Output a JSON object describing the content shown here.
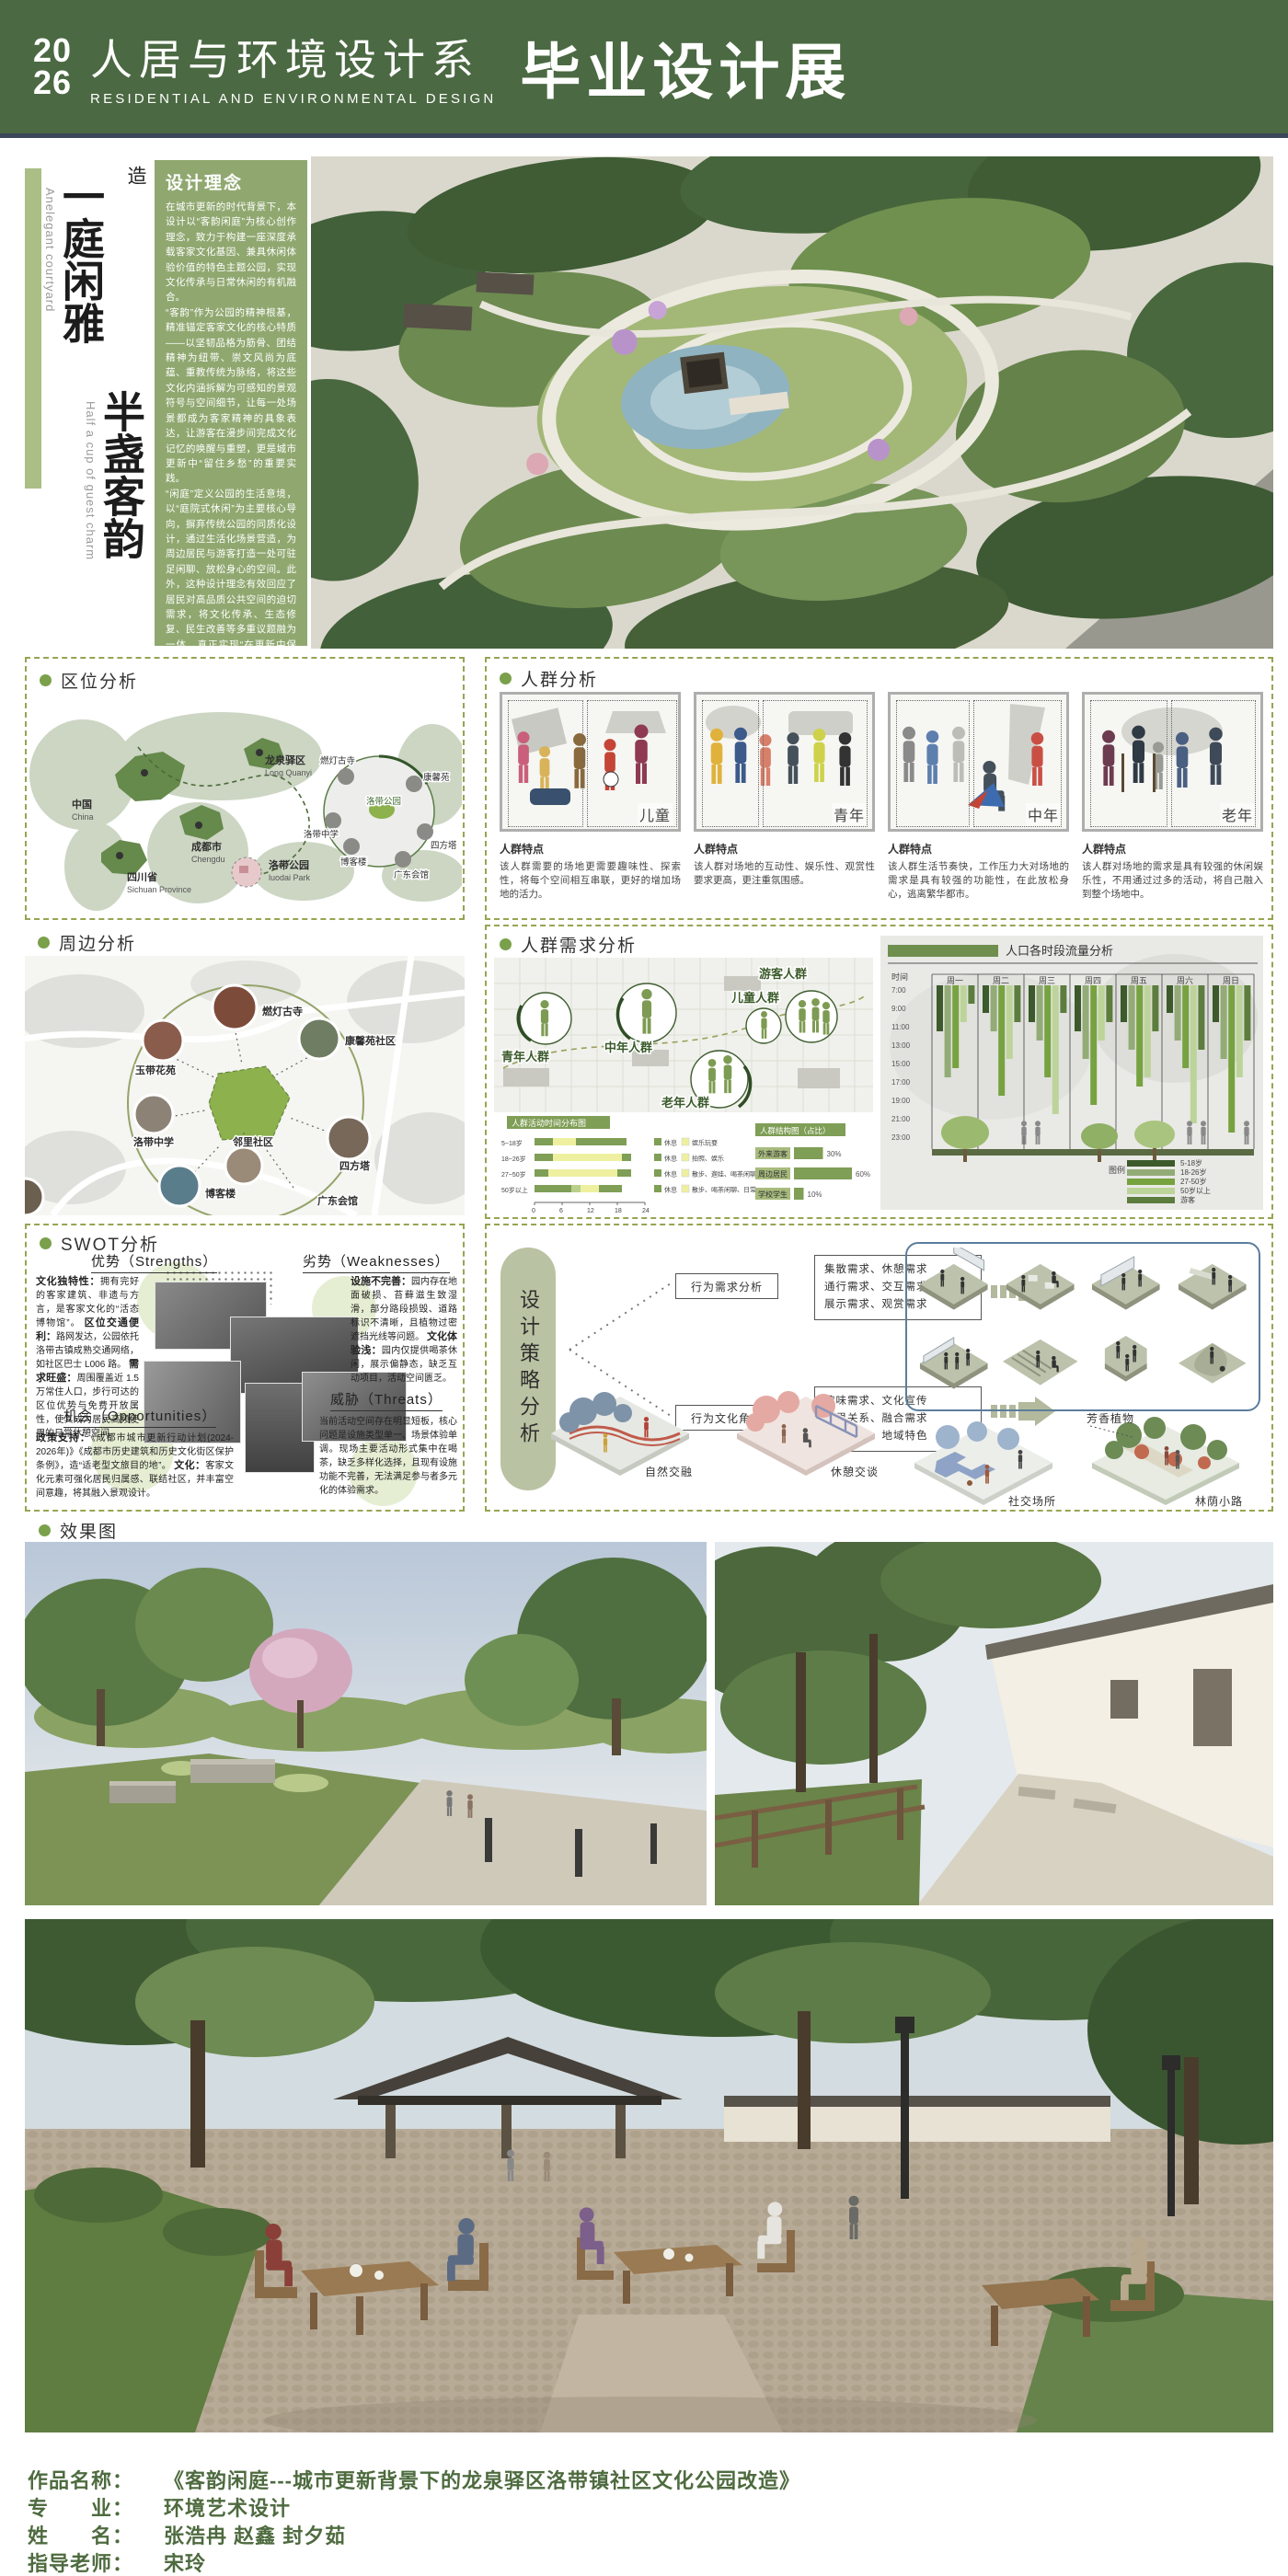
{
  "header": {
    "year_line1": "20",
    "year_line2": "26",
    "dept_cn": "人居与环境设计系",
    "dept_en": "RESIDENTIAL AND ENVIRONMENTAL DESIGN",
    "exhibition": "毕业设计展"
  },
  "hero": {
    "title_col1": "一庭闲雅",
    "title_col2": "半盏客韵",
    "title_en1": "Anelegant courtyard",
    "title_en2": "Half a cup of guest charm",
    "subtitle": "城市更新背景下的龙泉驿区洛带镇社区文化公园改造",
    "concept": {
      "title": "设计理念",
      "p1": "在城市更新的时代背景下，本设计以“客韵闲庭”为核心创作理念，致力于构建一座深度承载客家文化基因、兼具休闲体验价值的特色主题公园，实现文化传承与日常休闲的有机融合。",
      "p2": "“客韵”作为公园的精神根基，精准锚定客家文化的核心特质——以坚韧品格为筋骨、团结精神为纽带、崇文风尚为底蕴、重教传统为脉络，将这些文化内涵拆解为可感知的景观符号与空间细节，让每一处场景都成为客家精神的具象表达，让游客在漫步间完成文化记忆的唤醒与重塑，更是城市更新中“留住乡愁”的重要实践。",
      "p3": "“闲庭”定义公园的生活意境，以“庭院式休闲”为主要核心导向，摒弃传统公园的同质化设计，通过生活化场景营造，为周边居民与游客打造一处可驻足闲聊、放松身心的空间。此外，这种设计理念有效回应了居民对高品质公共空间的迫切需求，将文化传承、生态修复、民生改善等多重议题融为一体，真正实现“在更新中保护，在保护中发展”的可持续更新理念。"
    }
  },
  "location": {
    "label": "区位分析",
    "markers": [
      {
        "cn": "中国",
        "en": "China"
      },
      {
        "cn": "四川省",
        "en": "Sichuan Province"
      },
      {
        "cn": "成都市",
        "en": "Chengdu"
      },
      {
        "cn": "龙泉驿区",
        "en": "Long Quanyi"
      },
      {
        "cn": "洛带公园",
        "en": "luodai Park"
      }
    ],
    "inset": [
      "燃灯古寺",
      "康馨苑",
      "洛带公园",
      "洛带中学",
      "博客楼",
      "四方塔",
      "广东会馆"
    ]
  },
  "crowd": {
    "label": "人群分析",
    "trait_title": "人群特点",
    "groups": [
      {
        "name": "儿童",
        "trait": "该人群需要的场地更需要趣味性、探索性，将每个空间相互串联，更好的增加场地的活力。"
      },
      {
        "name": "青年",
        "trait": "该人群对场地的互动性、娱乐性、观赏性要求更高，更注重氛围感。"
      },
      {
        "name": "中年",
        "trait": "该人群生活节奏快，工作压力大对场地的需求是具有较强的功能性，在此放松身心，逃离繁华都市。"
      },
      {
        "name": "老年",
        "trait": "该人群对场地的需求是具有较强的休闲娱乐性，不用通过过多的活动，将自己融入到整个场地中。"
      }
    ]
  },
  "surrounding": {
    "label": "周边分析",
    "poi": [
      "燃灯古寺",
      "玉带花苑",
      "康馨苑社区",
      "洛带中学",
      "邻里社区",
      "四方塔",
      "博客楼",
      "广东会馆"
    ]
  },
  "needs": {
    "label": "人群需求分析",
    "map_groups": [
      "青年人群",
      "中年人群",
      "儿童人群",
      "游客人群",
      "老年人群"
    ]
  },
  "swot": {
    "label": "SWOT分析",
    "s_title": "优势（Strengths）",
    "w_title": "劣势（Weaknesses）",
    "o_title": "机会（Opportunities）",
    "t_title": "威胁（Threats）",
    "strengths": [
      {
        "lead": "文化独特性：",
        "text": "拥有完好的客家建筑、非遗与方言，是客家文化的“活态博物馆”。"
      },
      {
        "lead": "区位交通便利：",
        "text": "路网发达，公园依托洛带古镇成熟交通网络，如社区巴士 L006 路。"
      },
      {
        "lead": "需求旺盛：",
        "text": "周围覆盖近 1.5 万常住人口，步行可达的区位优势与免费开放属性，使其成为居民高频使用的日常休憩空间。"
      }
    ],
    "weaknesses": [
      {
        "lead": "设施不完善：",
        "text": "园内存在地面破损、苔藓滋生致湿滑，部分路段损毁、道路标识不清晰，且植物过密遮挡光线等问题。"
      },
      {
        "lead": "文化体验浅：",
        "text": "园内仅提供喝茶休闲，展示偏静态，缺乏互动项目，活动空间匮乏。"
      }
    ],
    "opportunities": [
      {
        "lead": "政策支持：",
        "text": "《成都市城市更新行动计划(2024-2026年)》《成都市历史建筑和历史文化街区保护条例》，造“适老型文旅目的地”。"
      },
      {
        "lead": "文化：",
        "text": "客家文化元素可强化居民归属感、联结社区，并丰富空间意趣，将其融入景观设计。"
      }
    ],
    "threats": [
      {
        "lead": "",
        "text": "当前活动空间存在明显短板，核心问题是设施类型单一、场景体验单调。现场主要活动形式集中在喝茶，缺乏多样化选择，且现有设施功能不完善，无法满足参与者多元化的体验需求。"
      }
    ]
  },
  "strategy": {
    "label": "设计策略分析",
    "pill": "设计策略分析",
    "b1": "行为需求分析",
    "b1_items": [
      "集散需求、休憩需求",
      "通行需求、交互需求",
      "展示需求、观赏需求"
    ],
    "b2": "行为文化角度",
    "b2_items": [
      "趣味需求、文化宣传",
      "邻里关系、融合需求",
      "知识普及、地域特色"
    ],
    "scenes": [
      "自然交融",
      "休憩交谈",
      "社交场所",
      "林荫小路"
    ],
    "annotation": "芳香植物"
  },
  "renders": {
    "label": "效果图"
  },
  "footer": {
    "rows": [
      {
        "k": "作品名称：",
        "v": "《客韵闲庭---城市更新背景下的龙泉驿区洛带镇社区文化公园改造》"
      },
      {
        "k": "专　　业：",
        "v": "环境艺术设计"
      },
      {
        "k": "姓　　名：",
        "v": "张浩冉  赵鑫  封夕茹"
      },
      {
        "k": "指导老师：",
        "v": "宋玲"
      }
    ]
  },
  "chart_data": [
    {
      "id": "activity",
      "type": "bar",
      "title": "人群活动时间分布图",
      "orientation": "horizontal-stacked",
      "xlabel": "时刻（时）",
      "x_ticks": [
        0,
        6,
        12,
        18,
        24
      ],
      "xlim": [
        0,
        24
      ],
      "legend_green": "休息",
      "rows": [
        {
          "label": "5~18岁",
          "segments": [
            [
              0,
              4,
              "g"
            ],
            [
              4,
              9,
              "y"
            ],
            [
              9,
              20,
              "g"
            ]
          ],
          "legend_yellow": "娱乐玩耍"
        },
        {
          "label": "18~26岁",
          "segments": [
            [
              0,
              4,
              "g"
            ],
            [
              4,
              19,
              "y"
            ],
            [
              19,
              21,
              "g"
            ]
          ],
          "legend_yellow": "拍照、娱乐"
        },
        {
          "label": "27~50岁",
          "segments": [
            [
              0,
              3,
              "g"
            ],
            [
              3,
              18,
              "y"
            ],
            [
              18,
              21,
              "g"
            ]
          ],
          "legend_yellow": "散步、遛娃、喝茶闲聊"
        },
        {
          "label": "50岁以上",
          "segments": [
            [
              0,
              8,
              "g"
            ],
            [
              8,
              10,
              "lg"
            ],
            [
              10,
              14,
              "y"
            ],
            [
              14,
              19,
              "g"
            ]
          ],
          "legend_yellow": "散步、喝茶闲聊、日常"
        }
      ]
    },
    {
      "id": "structure",
      "type": "bar",
      "title": "人群结构图（占比）",
      "unit": "%",
      "items": [
        {
          "label": "外来游客",
          "value": 30
        },
        {
          "label": "周边居民",
          "value": 60
        },
        {
          "label": "学校学生",
          "value": 10
        }
      ]
    },
    {
      "id": "flow",
      "type": "bar",
      "title": "人口各时段流量分析",
      "ylabel": "时间",
      "y_ticks": [
        "7:00",
        "9:00",
        "11:00",
        "13:00",
        "15:00",
        "17:00",
        "19:00",
        "21:00",
        "23:00"
      ],
      "days": [
        "周一",
        "周二",
        "周三",
        "周四",
        "周五",
        "周六",
        "周日"
      ],
      "legend_title": "图例",
      "legend": [
        "5-18岁",
        "18-26岁",
        "27-50岁",
        "50岁以上",
        "游客"
      ],
      "legend_colors": [
        "#3d5a2c",
        "#93ab77",
        "#76a23f",
        "#bcd49a",
        "#5c7d3d"
      ],
      "values_end_hour": [
        [
          12,
          17,
          16,
          11,
          9
        ],
        [
          10,
          12,
          19,
          15,
          11
        ],
        [
          11,
          13,
          17,
          21,
          10
        ],
        [
          12,
          15,
          20,
          13,
          11
        ],
        [
          11,
          14,
          18,
          17,
          12
        ],
        [
          10,
          13,
          16,
          22,
          14
        ],
        [
          11,
          15,
          23,
          17,
          13
        ]
      ]
    }
  ]
}
